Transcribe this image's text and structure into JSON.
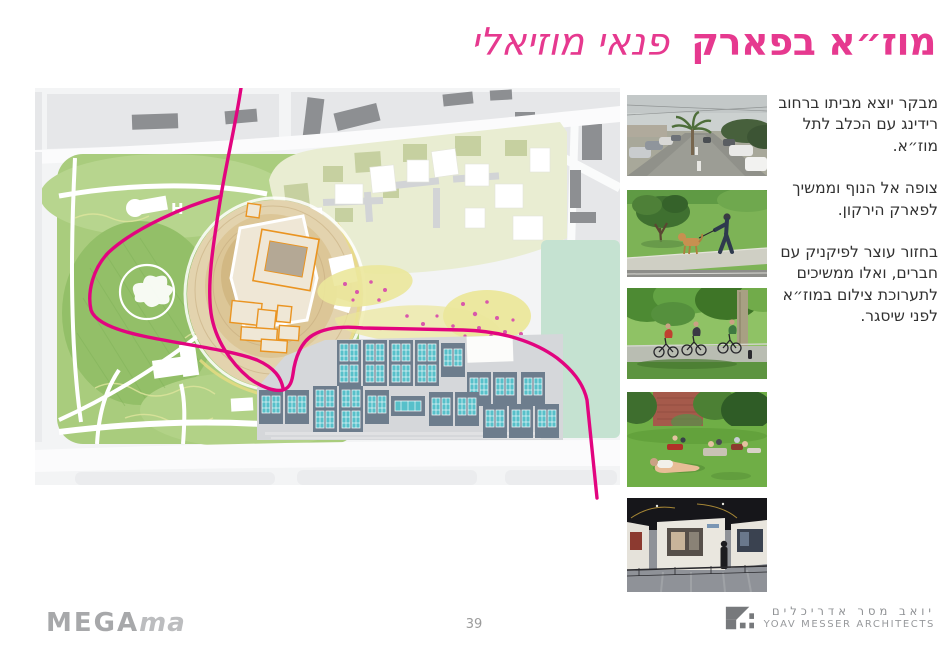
{
  "title": {
    "bold": "מוז״א בפארק",
    "light": "פנאי מוזיאלי"
  },
  "narrative": {
    "paragraphs": [
      "מבקר יוצא מביתו ברחוב רידינג עם הכלב לתל מוז״א.",
      "צופה אל הנוף וממשיך לפארק הירקון.",
      "בחזור עוצר לפיקניק עם חברים, ואלו ממשיכים לתערוכת צילום במוז״א לפני שיסגר."
    ]
  },
  "map": {
    "h_label": "H"
  },
  "photos": [
    {
      "name": "street-view-reading-street"
    },
    {
      "name": "dog-walk-in-park"
    },
    {
      "name": "cyclists-on-park-path"
    },
    {
      "name": "picnic-on-lawn"
    },
    {
      "name": "photo-exhibition-interior"
    }
  ],
  "footer": {
    "brand_bold": "MEGA",
    "brand_italic": "ma",
    "page_number": "39",
    "architect_he": "יואב מסר אדריכלים",
    "architect_en": "YOAV MESSER ARCHITECTS"
  },
  "colors": {
    "accent_pink": "#e6398f",
    "route_pink": "#e2047f"
  }
}
